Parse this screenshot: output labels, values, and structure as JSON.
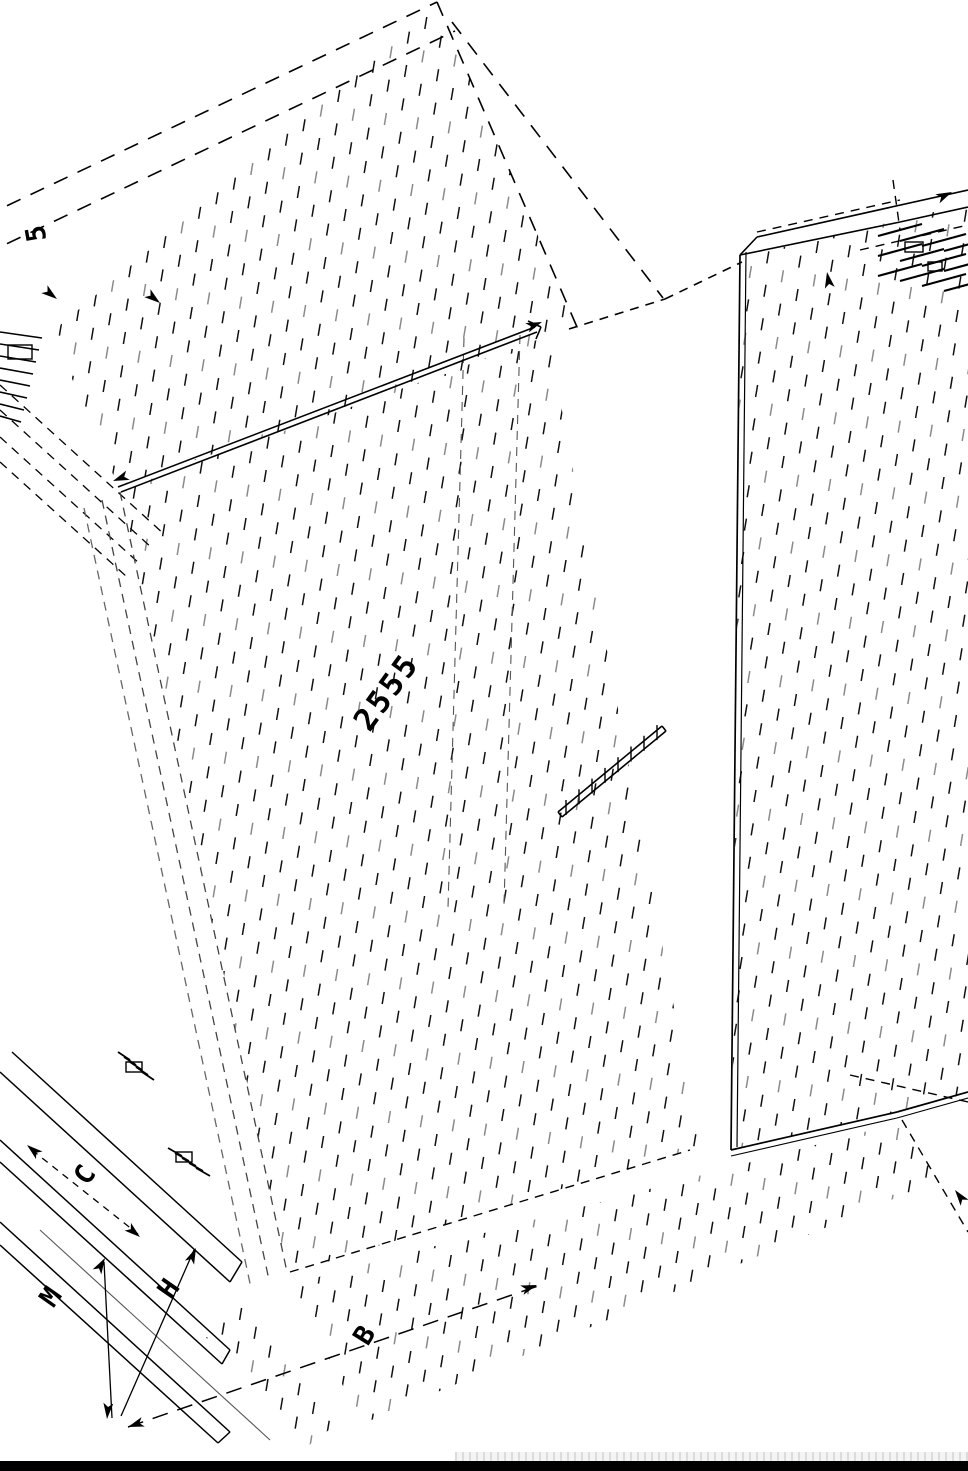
{
  "drawing": {
    "description": "Isometric CAD line drawing of a wardrobe cabinet, rotated, with dimension annotations",
    "labels": {
      "step": "5",
      "dim_length": "2555",
      "dim_c": "C",
      "dim_m": "M",
      "dim_h": "H",
      "dim_b": "B"
    },
    "icons": {
      "arrowhead": "filled-triangle-dimension-arrow"
    },
    "colors": {
      "line": "#000000",
      "line_light": "#8a8a8a",
      "background": "#ffffff",
      "footer_bar": "#000000",
      "footer_dots": "#dcdcdc"
    }
  }
}
